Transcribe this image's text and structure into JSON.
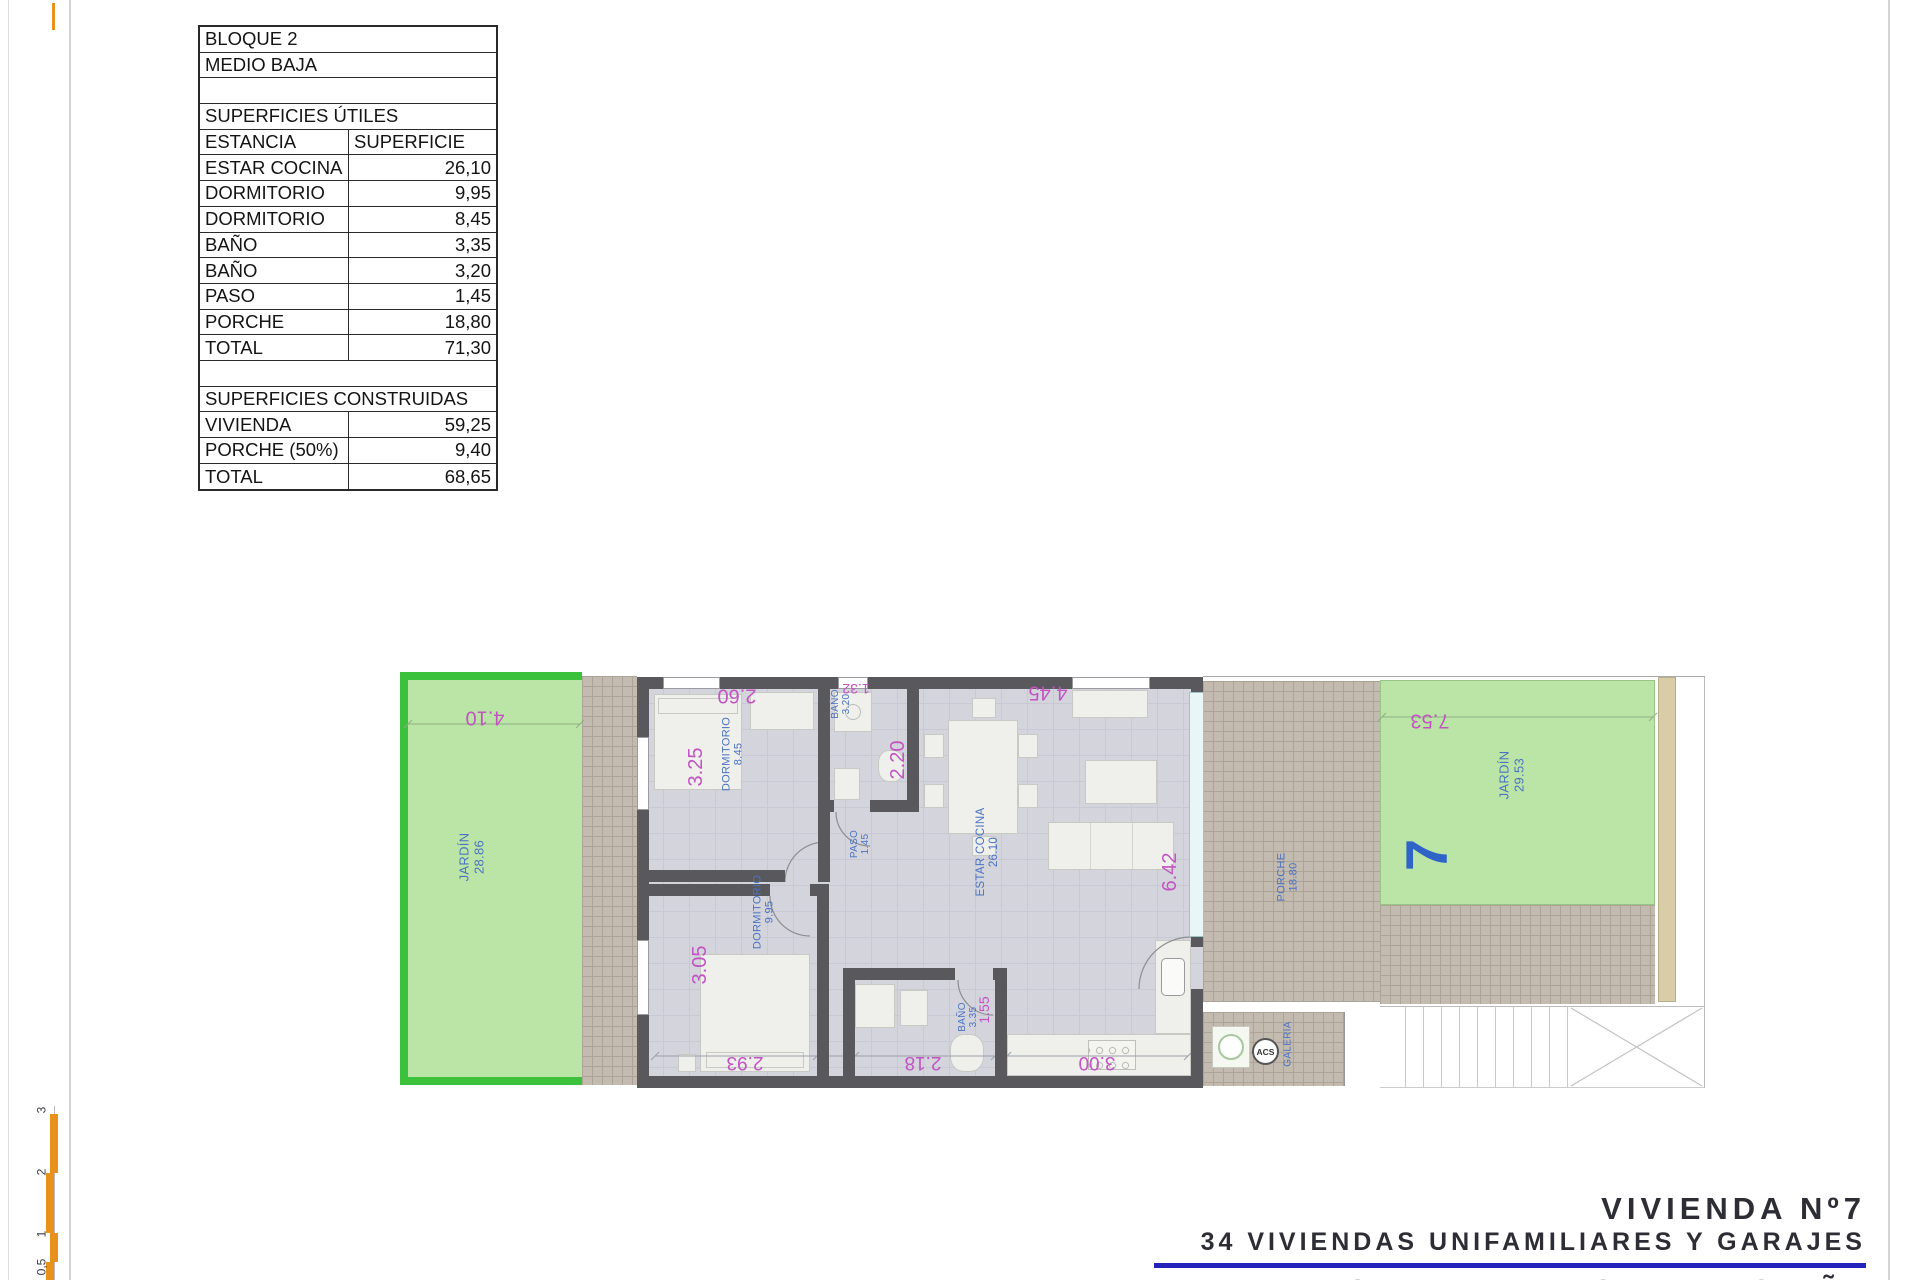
{
  "area_table": {
    "block": "BLOQUE 2",
    "level": "MEDIO BAJA",
    "useful_title": "SUPERFICIES ÚTILES",
    "col_room": "ESTANCIA",
    "col_area": "SUPERFICIE",
    "useful_rows": [
      {
        "name": "ESTAR COCINA",
        "value": "26,10"
      },
      {
        "name": "DORMITORIO",
        "value": "9,95"
      },
      {
        "name": "DORMITORIO",
        "value": "8,45"
      },
      {
        "name": "BAÑO",
        "value": "3,35"
      },
      {
        "name": "BAÑO",
        "value": "3,20"
      },
      {
        "name": "PASO",
        "value": "1,45"
      },
      {
        "name": "PORCHE",
        "value": "18,80"
      },
      {
        "name": "TOTAL",
        "value": "71,30"
      }
    ],
    "built_title": "SUPERFICIES CONSTRUIDAS",
    "built_rows": [
      {
        "name": "VIVIENDA",
        "value": "59,25"
      },
      {
        "name": "PORCHE (50%)",
        "value": "9,40"
      },
      {
        "name": "TOTAL",
        "value": "68,65"
      }
    ]
  },
  "plan": {
    "garden_left": {
      "name": "JARDÍN",
      "area": "28.86",
      "dim_top": "4.10"
    },
    "dorm1": {
      "name": "DORMITORIO",
      "area": "8.45",
      "dim_w": "2.60",
      "dim_h": "3.25"
    },
    "bath1": {
      "name": "BAÑO",
      "area": "3.20",
      "dim_w": "1.32",
      "dim_h": "2.20"
    },
    "paso": {
      "name": "PASO",
      "area": "1.45"
    },
    "estar": {
      "name": "ESTAR COCINA",
      "area": "26.10",
      "dim_top": "4.45",
      "dim_right": "6.42",
      "dim_bottom": "3.00"
    },
    "dorm2": {
      "name": "DORMITORIO",
      "area": "9.95",
      "dim_h": "3.05",
      "dim_bottom": "2.93"
    },
    "bath2": {
      "name": "BAÑO",
      "area": "3.35",
      "dim_h": "1.55",
      "dim_bottom": "2.18"
    },
    "porch": {
      "name": "PORCHE",
      "area": "18.80"
    },
    "galeria": {
      "name": "GALERIA",
      "acs": "ACS"
    },
    "garden_right": {
      "name": "JARDÍN",
      "area": "29.53",
      "dim_top": "7.53",
      "unit_number": "7"
    }
  },
  "scale_bar": {
    "ticks": [
      "3",
      "2",
      "1",
      "0,5"
    ]
  },
  "title_block": {
    "unit_title": "VIVIENDA Nº7",
    "project_title": "34 VIVIENDAS UNIFAMILIARES Y GARAJES",
    "location": "PILAR DE LA HORADADA, ALICANTE, ESPAÑA"
  },
  "colors": {
    "room_label_blue": "#4a72c2",
    "dimension_magenta": "#c253c2",
    "garden_fill": "#bbe5a6",
    "garden_border": "#3cc13c",
    "wall_gray": "#59595d",
    "tile_beige": "#c3bbb0",
    "accent_rule_blue": "#2323bb",
    "scale_orange": "#e8921b",
    "unit_number_blue": "#2f63c8"
  }
}
